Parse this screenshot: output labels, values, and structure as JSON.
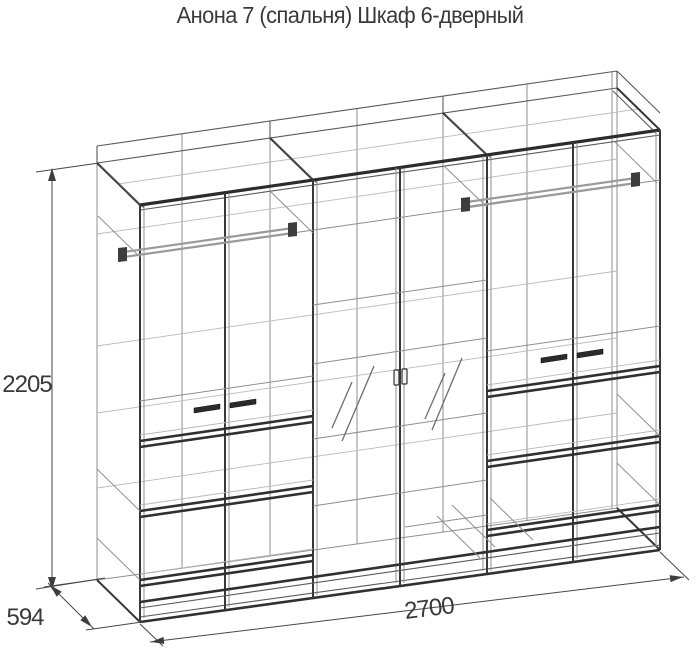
{
  "title": "Анона 7 (спальня) Шкаф 6-дверный",
  "dimensions": {
    "height_mm": "2205",
    "depth_mm": "594",
    "width_mm": "2700"
  },
  "diagram": {
    "type": "isometric wireframe technical drawing",
    "product": "wardrobe 6-door",
    "door_count": 6,
    "sections": [
      "left: hanging rod + 2 doors + drawers",
      "middle: 2 mirror doors with shelves",
      "right: hanging rod + 2 doors + drawers"
    ],
    "colors": {
      "background": "#ffffff",
      "primary_line": "#383838",
      "secondary_line": "#8f8f8f",
      "text": "#3a3a3a"
    }
  }
}
